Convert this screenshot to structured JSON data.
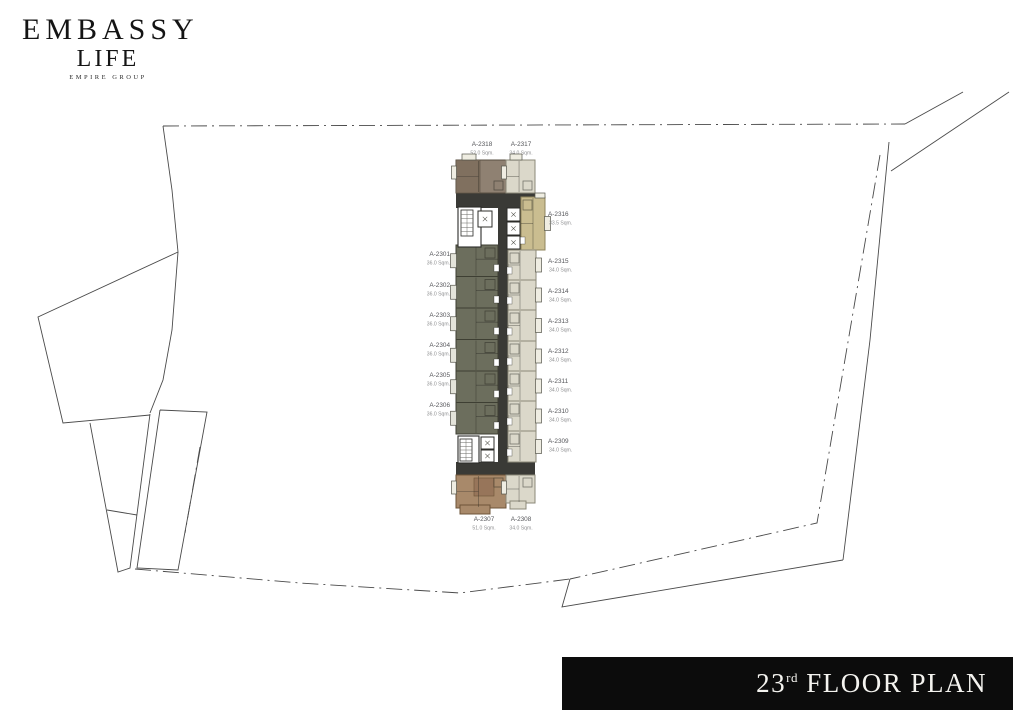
{
  "brand": {
    "name": "EMBASSY",
    "sub": "LIFE",
    "group": "EMPIRE GROUP"
  },
  "floor_label": {
    "number": "23",
    "suffix": "rd",
    "rest": " FLOOR PLAN"
  },
  "colors": {
    "olive": "#6c6e5d",
    "olive_stroke": "#3e3f33",
    "beige": "#dbd8ca",
    "beige_stroke": "#8b8878",
    "tan": "#cabd90",
    "tan_stroke": "#8f845c",
    "taupe": "#8f8172",
    "taupe_dark": "#80705f",
    "taupe_stroke": "#5a5043",
    "brown": "#a8896a",
    "brown_dark": "#97755a",
    "brown_stroke": "#6e5438",
    "dark": "#3a3a36",
    "balcony_l": "#e4e4da",
    "balcony_r": "#efede2",
    "boundary": "#4a4a4a",
    "wall": "#2c2c29"
  },
  "plan": {
    "units": [
      {
        "id": "A-2318",
        "area": "52.0 Sqm.",
        "cat": "taupe",
        "side": "top",
        "rect": [
          456,
          160,
          50,
          33
        ],
        "label": {
          "x": 482,
          "y": 146,
          "anchor": "middle"
        },
        "rooms": [
          [
            456,
            160,
            24,
            33
          ]
        ]
      },
      {
        "id": "A-2317",
        "area": "34.0 Sqm.",
        "cat": "beige",
        "side": "top",
        "rect": [
          506,
          160,
          29,
          33
        ],
        "label": {
          "x": 521,
          "y": 146,
          "anchor": "middle"
        }
      },
      {
        "id": "A-2316",
        "area": "33.5 Sqm.",
        "cat": "tan",
        "side": "right",
        "rect": [
          521,
          197,
          24,
          53
        ],
        "label": {
          "x": 548,
          "y": 216,
          "anchor": "start"
        }
      },
      {
        "id": "A-2301",
        "area": "36.0 Sqm.",
        "cat": "olive",
        "side": "left",
        "rect": [
          456,
          245,
          42,
          31.5
        ],
        "label": {
          "x": 450,
          "y": 256,
          "anchor": "end"
        }
      },
      {
        "id": "A-2302",
        "area": "36.0 Sqm.",
        "cat": "olive",
        "side": "left",
        "rect": [
          456,
          276.5,
          42,
          31.5
        ],
        "label": {
          "x": 450,
          "y": 287,
          "anchor": "end"
        }
      },
      {
        "id": "A-2303",
        "area": "36.0 Sqm.",
        "cat": "olive",
        "side": "left",
        "rect": [
          456,
          308,
          42,
          31.5
        ],
        "label": {
          "x": 450,
          "y": 317,
          "anchor": "end"
        }
      },
      {
        "id": "A-2304",
        "area": "36.0 Sqm.",
        "cat": "olive",
        "side": "left",
        "rect": [
          456,
          339.5,
          42,
          31.5
        ],
        "label": {
          "x": 450,
          "y": 347,
          "anchor": "end"
        }
      },
      {
        "id": "A-2305",
        "area": "36.0 Sqm.",
        "cat": "olive",
        "side": "left",
        "rect": [
          456,
          371,
          42,
          31.5
        ],
        "label": {
          "x": 450,
          "y": 377,
          "anchor": "end"
        }
      },
      {
        "id": "A-2306",
        "area": "36.0 Sqm.",
        "cat": "olive",
        "side": "left",
        "rect": [
          456,
          402.5,
          42,
          31.5
        ],
        "label": {
          "x": 450,
          "y": 407,
          "anchor": "end"
        }
      },
      {
        "id": "A-2315",
        "area": "34.0 Sqm.",
        "cat": "beige",
        "side": "right",
        "rect": [
          508,
          250,
          28,
          30
        ],
        "label": {
          "x": 548,
          "y": 263,
          "anchor": "start"
        }
      },
      {
        "id": "A-2314",
        "area": "34.0 Sqm.",
        "cat": "beige",
        "side": "right",
        "rect": [
          508,
          280,
          28,
          30
        ],
        "label": {
          "x": 548,
          "y": 293,
          "anchor": "start"
        }
      },
      {
        "id": "A-2313",
        "area": "34.0 Sqm.",
        "cat": "beige",
        "side": "right",
        "rect": [
          508,
          310,
          28,
          31
        ],
        "label": {
          "x": 548,
          "y": 323,
          "anchor": "start"
        }
      },
      {
        "id": "A-2312",
        "area": "34.0 Sqm.",
        "cat": "beige",
        "side": "right",
        "rect": [
          508,
          341,
          28,
          30
        ],
        "label": {
          "x": 548,
          "y": 353,
          "anchor": "start"
        }
      },
      {
        "id": "A-2311",
        "area": "34.0 Sqm.",
        "cat": "beige",
        "side": "right",
        "rect": [
          508,
          371,
          28,
          30
        ],
        "label": {
          "x": 548,
          "y": 383,
          "anchor": "start"
        }
      },
      {
        "id": "A-2310",
        "area": "34.0 Sqm.",
        "cat": "beige",
        "side": "right",
        "rect": [
          508,
          401,
          28,
          30
        ],
        "label": {
          "x": 548,
          "y": 413,
          "anchor": "start"
        }
      },
      {
        "id": "A-2309",
        "area": "34.0 Sqm.",
        "cat": "beige",
        "side": "right",
        "rect": [
          508,
          431,
          28,
          31
        ],
        "label": {
          "x": 548,
          "y": 443,
          "anchor": "start"
        }
      },
      {
        "id": "A-2307",
        "area": "51.0 Sqm.",
        "cat": "brown",
        "side": "bottom",
        "rect": [
          456,
          475,
          50,
          33
        ],
        "label": {
          "x": 484,
          "y": 521,
          "anchor": "middle"
        },
        "rooms": [
          [
            474,
            478,
            20,
            18
          ]
        ],
        "extra": [
          [
            460,
            505,
            30,
            9
          ]
        ]
      },
      {
        "id": "A-2308",
        "area": "34.0 Sqm.",
        "cat": "beige",
        "side": "bottom",
        "rect": [
          506,
          475,
          29,
          28
        ],
        "label": {
          "x": 521,
          "y": 521,
          "anchor": "middle"
        },
        "extra": [
          [
            510,
            501,
            16,
            8
          ]
        ]
      }
    ],
    "core": [
      {
        "type": "band",
        "r": [
          456,
          193,
          79,
          15
        ]
      },
      {
        "type": "band",
        "r": [
          498,
          193,
          10,
          282
        ]
      },
      {
        "type": "band",
        "r": [
          456,
          462,
          79,
          13
        ]
      },
      {
        "type": "band",
        "r": [
          505,
          205,
          18,
          46
        ]
      },
      {
        "type": "room",
        "r": [
          458,
          207,
          23,
          40
        ]
      },
      {
        "type": "stair",
        "r": [
          461,
          210,
          12,
          26
        ]
      },
      {
        "type": "lift",
        "r": [
          478,
          211,
          14,
          16
        ]
      },
      {
        "type": "lift",
        "r": [
          507,
          208,
          13,
          13
        ]
      },
      {
        "type": "lift",
        "r": [
          507,
          222,
          13,
          13
        ]
      },
      {
        "type": "lift",
        "r": [
          507,
          236,
          13,
          13
        ]
      },
      {
        "type": "room",
        "r": [
          458,
          436,
          21,
          27
        ]
      },
      {
        "type": "stair",
        "r": [
          460,
          439,
          12,
          22
        ]
      },
      {
        "type": "lift",
        "r": [
          481,
          437,
          13,
          12
        ]
      },
      {
        "type": "lift",
        "r": [
          481,
          450,
          13,
          12
        ]
      },
      {
        "type": "bump",
        "r": [
          462,
          154,
          14,
          6
        ]
      },
      {
        "type": "bump",
        "r": [
          510,
          154,
          12,
          6
        ]
      },
      {
        "type": "bump",
        "r": [
          535,
          193,
          10,
          5
        ]
      }
    ],
    "boundary": [
      {
        "pts": [
          [
            163,
            126
          ],
          [
            905,
            124
          ]
        ],
        "dash": "dashdot"
      },
      {
        "pts": [
          [
            905,
            124
          ],
          [
            963,
            92
          ]
        ],
        "dash": "solid"
      },
      {
        "pts": [
          [
            891,
            171
          ],
          [
            1009,
            92
          ]
        ],
        "dash": "solid"
      },
      {
        "pts": [
          [
            889,
            142
          ],
          [
            870,
            340
          ],
          [
            843,
            560
          ]
        ],
        "dash": "solid"
      },
      {
        "pts": [
          [
            880,
            155
          ],
          [
            817,
            523
          ],
          [
            570,
            579
          ]
        ],
        "dash": "dashdot"
      },
      {
        "pts": [
          [
            570,
            579
          ],
          [
            562,
            607
          ],
          [
            843,
            560
          ]
        ],
        "dash": "solid"
      },
      {
        "pts": [
          [
            135,
            569
          ],
          [
            300,
            583
          ],
          [
            460,
            593
          ],
          [
            570,
            579
          ]
        ],
        "dash": "dashdot"
      },
      {
        "pts": [
          [
            163,
            126
          ],
          [
            172,
            190
          ],
          [
            178,
            252
          ],
          [
            172,
            330
          ],
          [
            163,
            380
          ],
          [
            150,
            413
          ]
        ],
        "dash": "solid"
      },
      {
        "pts": [
          [
            178,
            252
          ],
          [
            38,
            317
          ],
          [
            63,
            423
          ],
          [
            150,
            415
          ]
        ],
        "dash": "solid"
      },
      {
        "pts": [
          [
            90,
            423
          ],
          [
            118,
            572
          ],
          [
            130,
            568
          ],
          [
            150,
            414
          ]
        ],
        "dash": "solid"
      },
      {
        "pts": [
          [
            107,
            510
          ],
          [
            137,
            515
          ]
        ],
        "dash": "solid"
      },
      {
        "pts": [
          [
            160,
            410
          ],
          [
            207,
            412
          ],
          [
            178,
            570
          ],
          [
            137,
            568
          ],
          [
            160,
            410
          ]
        ],
        "dash": "solid"
      },
      {
        "pts": [
          [
            200,
            447
          ],
          [
            185,
            533
          ]
        ],
        "dash": "dashdot"
      }
    ]
  }
}
